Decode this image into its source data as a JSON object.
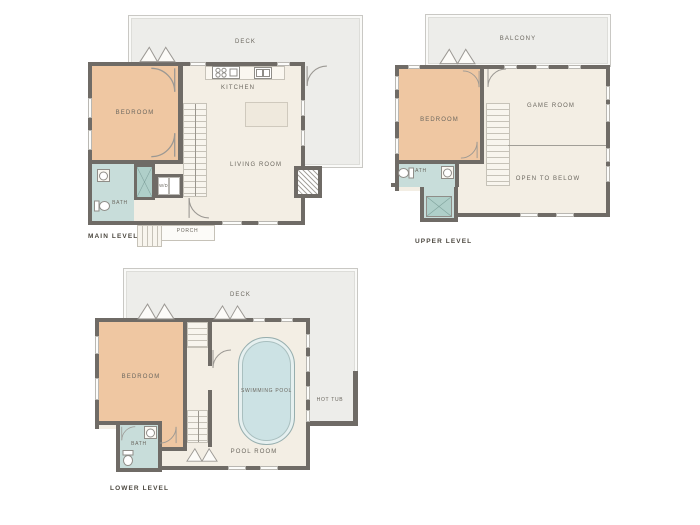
{
  "palette": {
    "wall": "#6F6B66",
    "floor": "#F3EEE4",
    "bedroom_fill": "#EFC7A2",
    "bath_fill": "#C8DDDA",
    "shower_fill": "#AFCFC9",
    "pool_fill": "#CCE2E4",
    "deck_fill": "#EDEDEA",
    "label_text": "#6B675F",
    "level_text": "#4C4840"
  },
  "levels": {
    "main": {
      "name": "MAIN LEVEL",
      "deck": "DECK",
      "kitchen": "KITCHEN",
      "bedroom": "BEDROOM",
      "living_room": "LIVING ROOM",
      "bath": "BATH",
      "laundry": "W/D",
      "porch": "PORCH"
    },
    "upper": {
      "name": "UPPER LEVEL",
      "balcony": "BALCONY",
      "bedroom": "BEDROOM",
      "game_room": "GAME ROOM",
      "open_to_below": "OPEN TO BELOW",
      "bath": "BATH"
    },
    "lower": {
      "name": "LOWER LEVEL",
      "deck": "DECK",
      "bedroom": "BEDROOM",
      "swimming_pool": "SWIMMING POOL",
      "pool_room": "POOL ROOM",
      "hot_tub": "HOT TUB",
      "bath": "BATH"
    }
  }
}
